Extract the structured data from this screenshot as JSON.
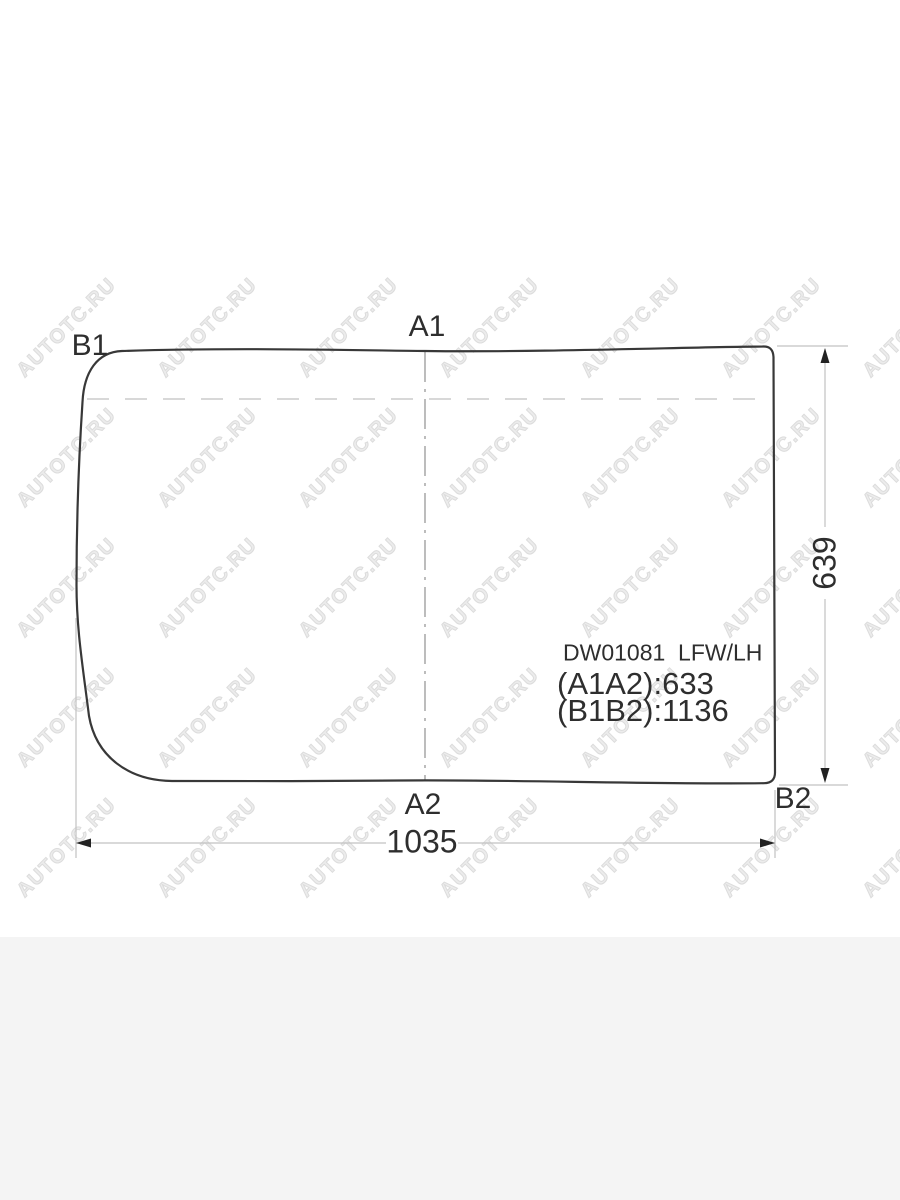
{
  "watermark": {
    "text": "AUTOTC.RU"
  },
  "diagram": {
    "labels": {
      "top_left": "B1",
      "top_center": "A1",
      "bottom_center": "A2",
      "bottom_right": "B2"
    },
    "part_code": "DW01081  LFW/LH",
    "spec_a": "(A1A2):633",
    "spec_b": "(B1B2):1136",
    "height_dim": "639",
    "width_dim": "1035"
  },
  "colors": {
    "outline": "#383838",
    "dimension_line": "#c2c2c2",
    "dashed_line": "#cccccc",
    "centerline": "#999999",
    "arrow": "#222222",
    "label_text": "#2e2e2e",
    "watermark_text": "#e5e5e5",
    "bottom_band": "#f4f4f4"
  }
}
